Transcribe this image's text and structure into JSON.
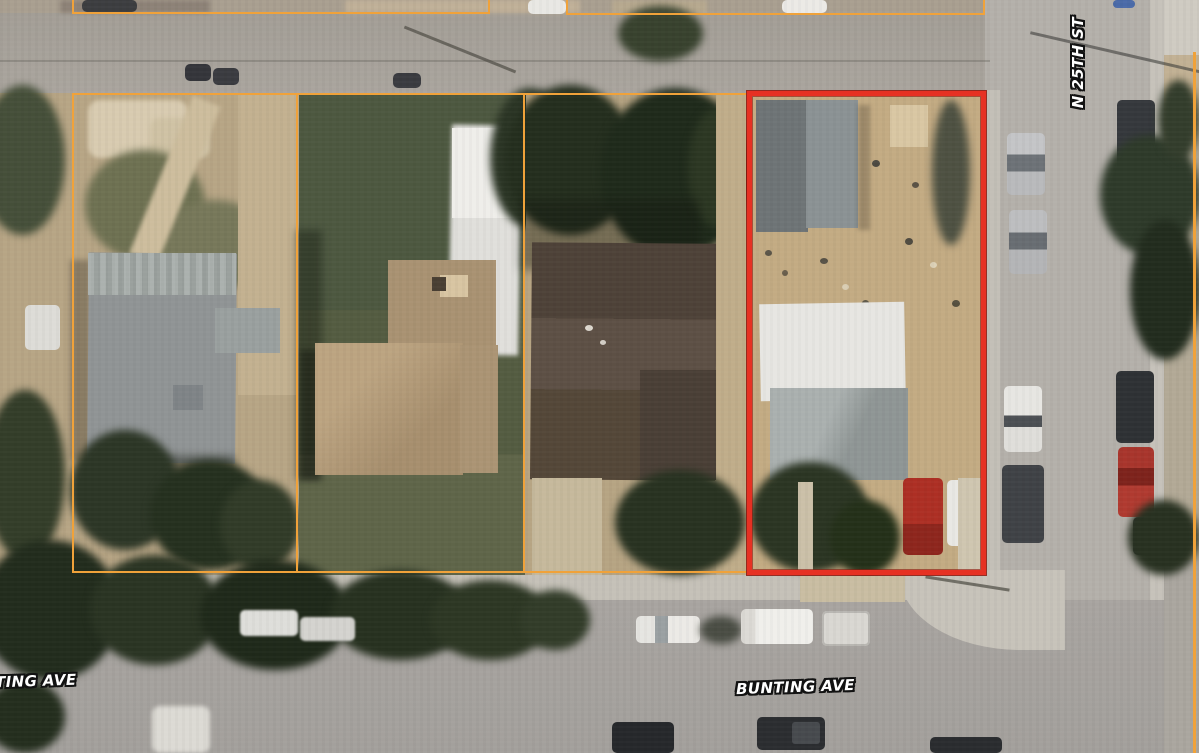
{
  "map": {
    "view": "aerial-parcel-map",
    "street_labels": {
      "right_vertical": "N 25TH ST",
      "bottom_center": "BUNTING AVE",
      "bottom_left_partial": "TING AVE"
    },
    "overlay": {
      "parcel_outline_color": "#F0A23A",
      "highlight_outline_color": "#E63123",
      "outlined_parcels": 5,
      "highlighted_parcels": 1
    }
  }
}
